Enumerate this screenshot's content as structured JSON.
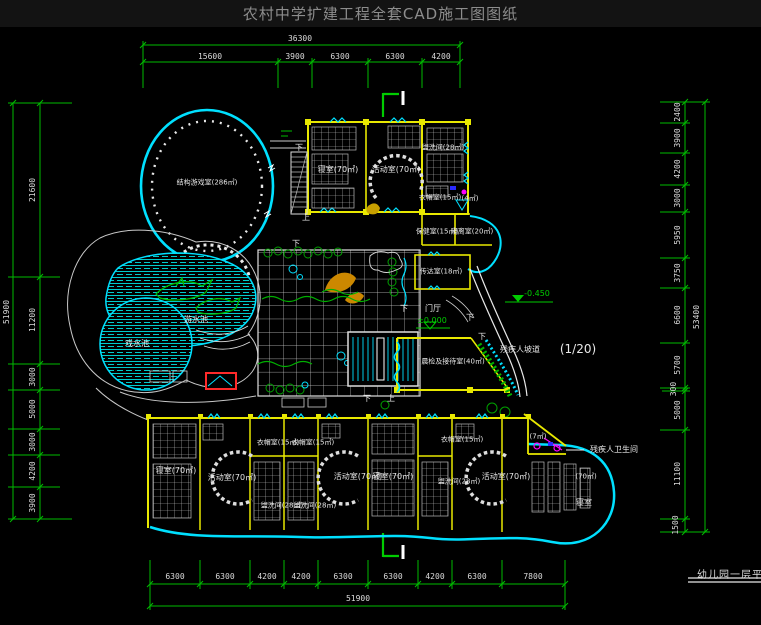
{
  "header": {
    "title": "农村中学扩建工程全套CAD施工图图纸"
  },
  "title_block": {
    "drawing_name": "幼儿园一层平面图"
  },
  "dimensions": {
    "top": {
      "total": "36300",
      "segments": [
        "15600",
        "3900",
        "6300",
        "6300",
        "4200"
      ]
    },
    "left": {
      "total": "51900",
      "segments": [
        "21600",
        "11200",
        "3000",
        "5000",
        "3000",
        "4200",
        "3900"
      ]
    },
    "right": {
      "total": "53400",
      "segments": [
        "2400",
        "3900",
        "4200",
        "3000",
        "5950",
        "3750",
        "6600",
        "5700",
        "300",
        "5000",
        "11100",
        "1500"
      ]
    },
    "bottom": {
      "total": "51900",
      "segments": [
        "6300",
        "6300",
        "4200",
        "4200",
        "6300",
        "6300",
        "4200",
        "6300",
        "7800"
      ]
    }
  },
  "rooms": {
    "play_hall": "结构游戏室(286㎡)",
    "bedroom_1": "寝室(70㎡)",
    "activity_1": "活动室(70㎡)",
    "washroom_1": "盥洗间(28㎡)",
    "cloakroom_1": "衣帽室(15㎡)",
    "shaft": "(4㎡)",
    "clinic": "保健室(15㎡)",
    "isolation": "隔离室(20㎡)",
    "reception": "传达室(18㎡)",
    "entrance_hall": "门厅",
    "morning_check": "晨检及接待室(40㎡)",
    "pool_big": "游水池",
    "pool_small": "戏水池",
    "bedroom_2": "寝室(70㎡)",
    "activity_2": "活动室(70㎡)",
    "cloakroom_2a": "衣帽室(15㎡)",
    "cloakroom_2b": "衣帽室(15㎡)",
    "washroom_2a": "盥洗间(28㎡)",
    "washroom_2b": "盥洗间(28㎡)",
    "activity_3": "活动室(70㎡)",
    "bedroom_mid": "寝室(70㎡)",
    "cloakroom_3": "衣帽室(15㎡)",
    "washroom_3": "盥洗间(28㎡)",
    "activity_4": "活动室(70㎡)",
    "wc_small": "(7㎡)",
    "accessible_wc": "残疾人卫生间",
    "bedroom_3_area": "(70㎡)",
    "bedroom_3": "寝室"
  },
  "annotations": {
    "level_zero": "±0.000",
    "level_minus": "-0.450",
    "ramp": "残疾人坡道",
    "ramp_scale": "(1/20)",
    "up": "上",
    "down": "下"
  },
  "colors": {
    "dimension_green": "#00bb00",
    "wall_yellow": "#e8e800",
    "glazing_cyan": "#00e0ff",
    "furniture_white": "#d8d8d8",
    "alert_red": "#ff2a2a",
    "fixture_magenta": "#ff00ff",
    "water_cyan": "#00cccc",
    "plant_green": "#00a000"
  }
}
